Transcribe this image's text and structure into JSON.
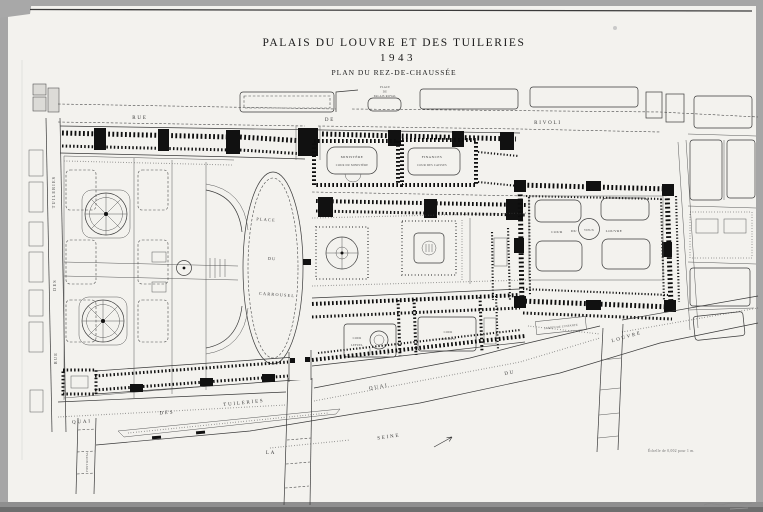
{
  "title": {
    "line1": "PALAIS DU LOUVRE ET DES TUILERIES",
    "line2": "1943",
    "line3": "PLAN DU REZ-DE-CHAUSSÉE"
  },
  "streets": {
    "rivoli": [
      "RUE",
      "DE",
      "RIVOLI"
    ],
    "rue_des_tuileries": [
      "RUE",
      "DES",
      "TUILERIES"
    ],
    "quai_des_tuileries": [
      "QUAI",
      "DES",
      "TUILERIES"
    ],
    "quai_du_louvre": [
      "QUAI",
      "DU",
      "LOUVRE"
    ],
    "pont_royal": "PONT ROYAL"
  },
  "places": {
    "palais_royal": [
      "PLACE",
      "DU",
      "PALAIS ROYAL"
    ],
    "carrousel": [
      "PLACE",
      "DU",
      "CARROUSEL"
    ]
  },
  "courts": {
    "ministere": "MINISTÈRE",
    "cour_du_ministere": "COUR DU MINISTÈRE",
    "finances": "FINANCES",
    "cour_des_caisses": "COUR DES CAISSES",
    "vieux_louvre": [
      "COUR",
      "DU",
      "VIEUX",
      "LOUVRE"
    ],
    "lefuel": [
      "COUR",
      "LEFUEL"
    ],
    "visconti": [
      "COUR",
      "VISCONTI"
    ],
    "jardin_infante": "JARDIN DE L'INFANTE"
  },
  "river": {
    "la": "LA",
    "seine": "SEINE"
  },
  "notes": {
    "scale": "Échelle de 0,002 pour 1 m."
  }
}
